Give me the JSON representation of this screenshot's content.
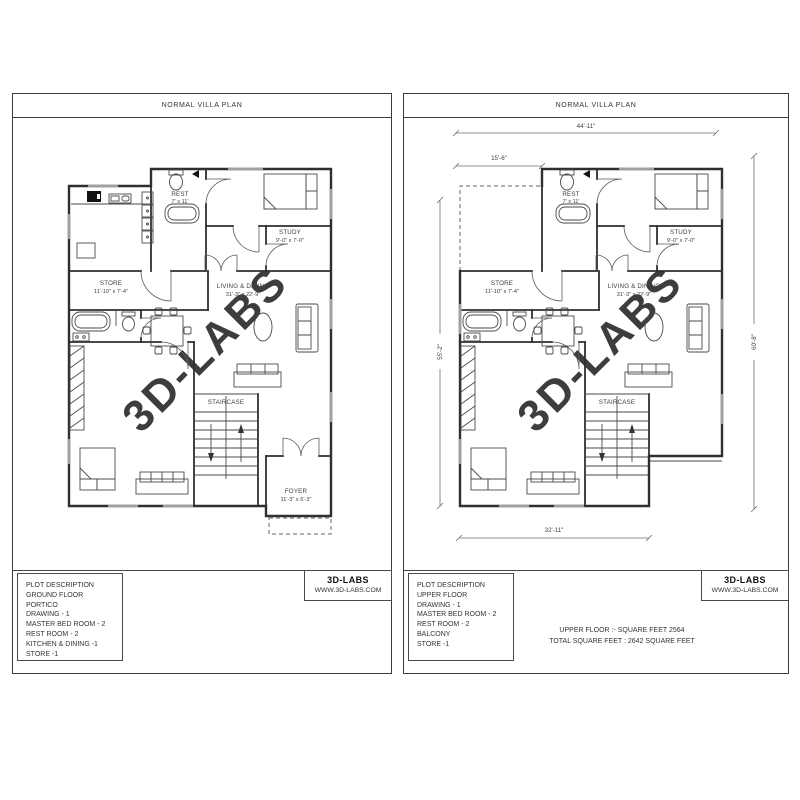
{
  "colors": {
    "wall": "#2f2f2f",
    "watermark": "#d7d7d7",
    "window": "#a0a0a0"
  },
  "left_sheet": {
    "title": "NORMAL VILLA PLAN",
    "watermark": "3D-LABS",
    "rooms": {
      "rest_name": "REST",
      "rest_dim": "7' x 11'",
      "study_name": "STUDY",
      "study_dim": "9'-0\" x 7'-0\"",
      "store_name": "STORE",
      "store_dim": "11'-10\" x 7'-4\"",
      "living_name": "LIVING & DINING",
      "living_dim": "31'-3\" x 22'-9\"",
      "staircase_name": "STAIRCASE",
      "foyer_name": "FOYER",
      "foyer_dim": "11'-3\" x 6'-3\""
    },
    "plot_description": [
      "PLOT DESCRIPTION",
      "GROUND FLOOR",
      "PORTICO",
      "DRAWING  - 1",
      "MASTER BED ROOM - 2",
      "REST ROOM - 2",
      "KITCHEN & DINING -1",
      "STORE -1"
    ],
    "brand": {
      "name": "3D-LABS",
      "website": "WWW.3D-LABS.COM"
    }
  },
  "right_sheet": {
    "title": "NORMAL VILLA PLAN",
    "watermark": "3D-LABS",
    "rooms": {
      "rest_name": "REST",
      "rest_dim": "7' x 11'",
      "study_name": "STUDY",
      "study_dim": "9'-0\" x 7'-0\"",
      "store_name": "STORE",
      "store_dim": "11'-10\" x 7'-4\"",
      "living_name": "LIVING & DINING",
      "living_dim": "31'-3\" x 22'-9\"",
      "staircase_name": "STAIRCASE"
    },
    "dimensions": {
      "top": "44'-11\"",
      "upper_left": "15'-6\"",
      "left": "55'-2\"",
      "right": "60'-8\"",
      "bottom": "32'-11\""
    },
    "plot_description": [
      "PLOT DESCRIPTION",
      "UPPER FLOOR",
      "DRAWING  - 1",
      "MASTER BED ROOM - 2",
      "REST ROOM - 2",
      "BALCONY",
      "STORE -1"
    ],
    "area_summary": [
      "UPPER FLOOR :- SQUARE FEET 2564",
      "TOTAL SQUARE FEET : 2642 SQUARE FEET"
    ],
    "brand": {
      "name": "3D-LABS",
      "website": "WWW.3D-LABS.COM"
    }
  }
}
